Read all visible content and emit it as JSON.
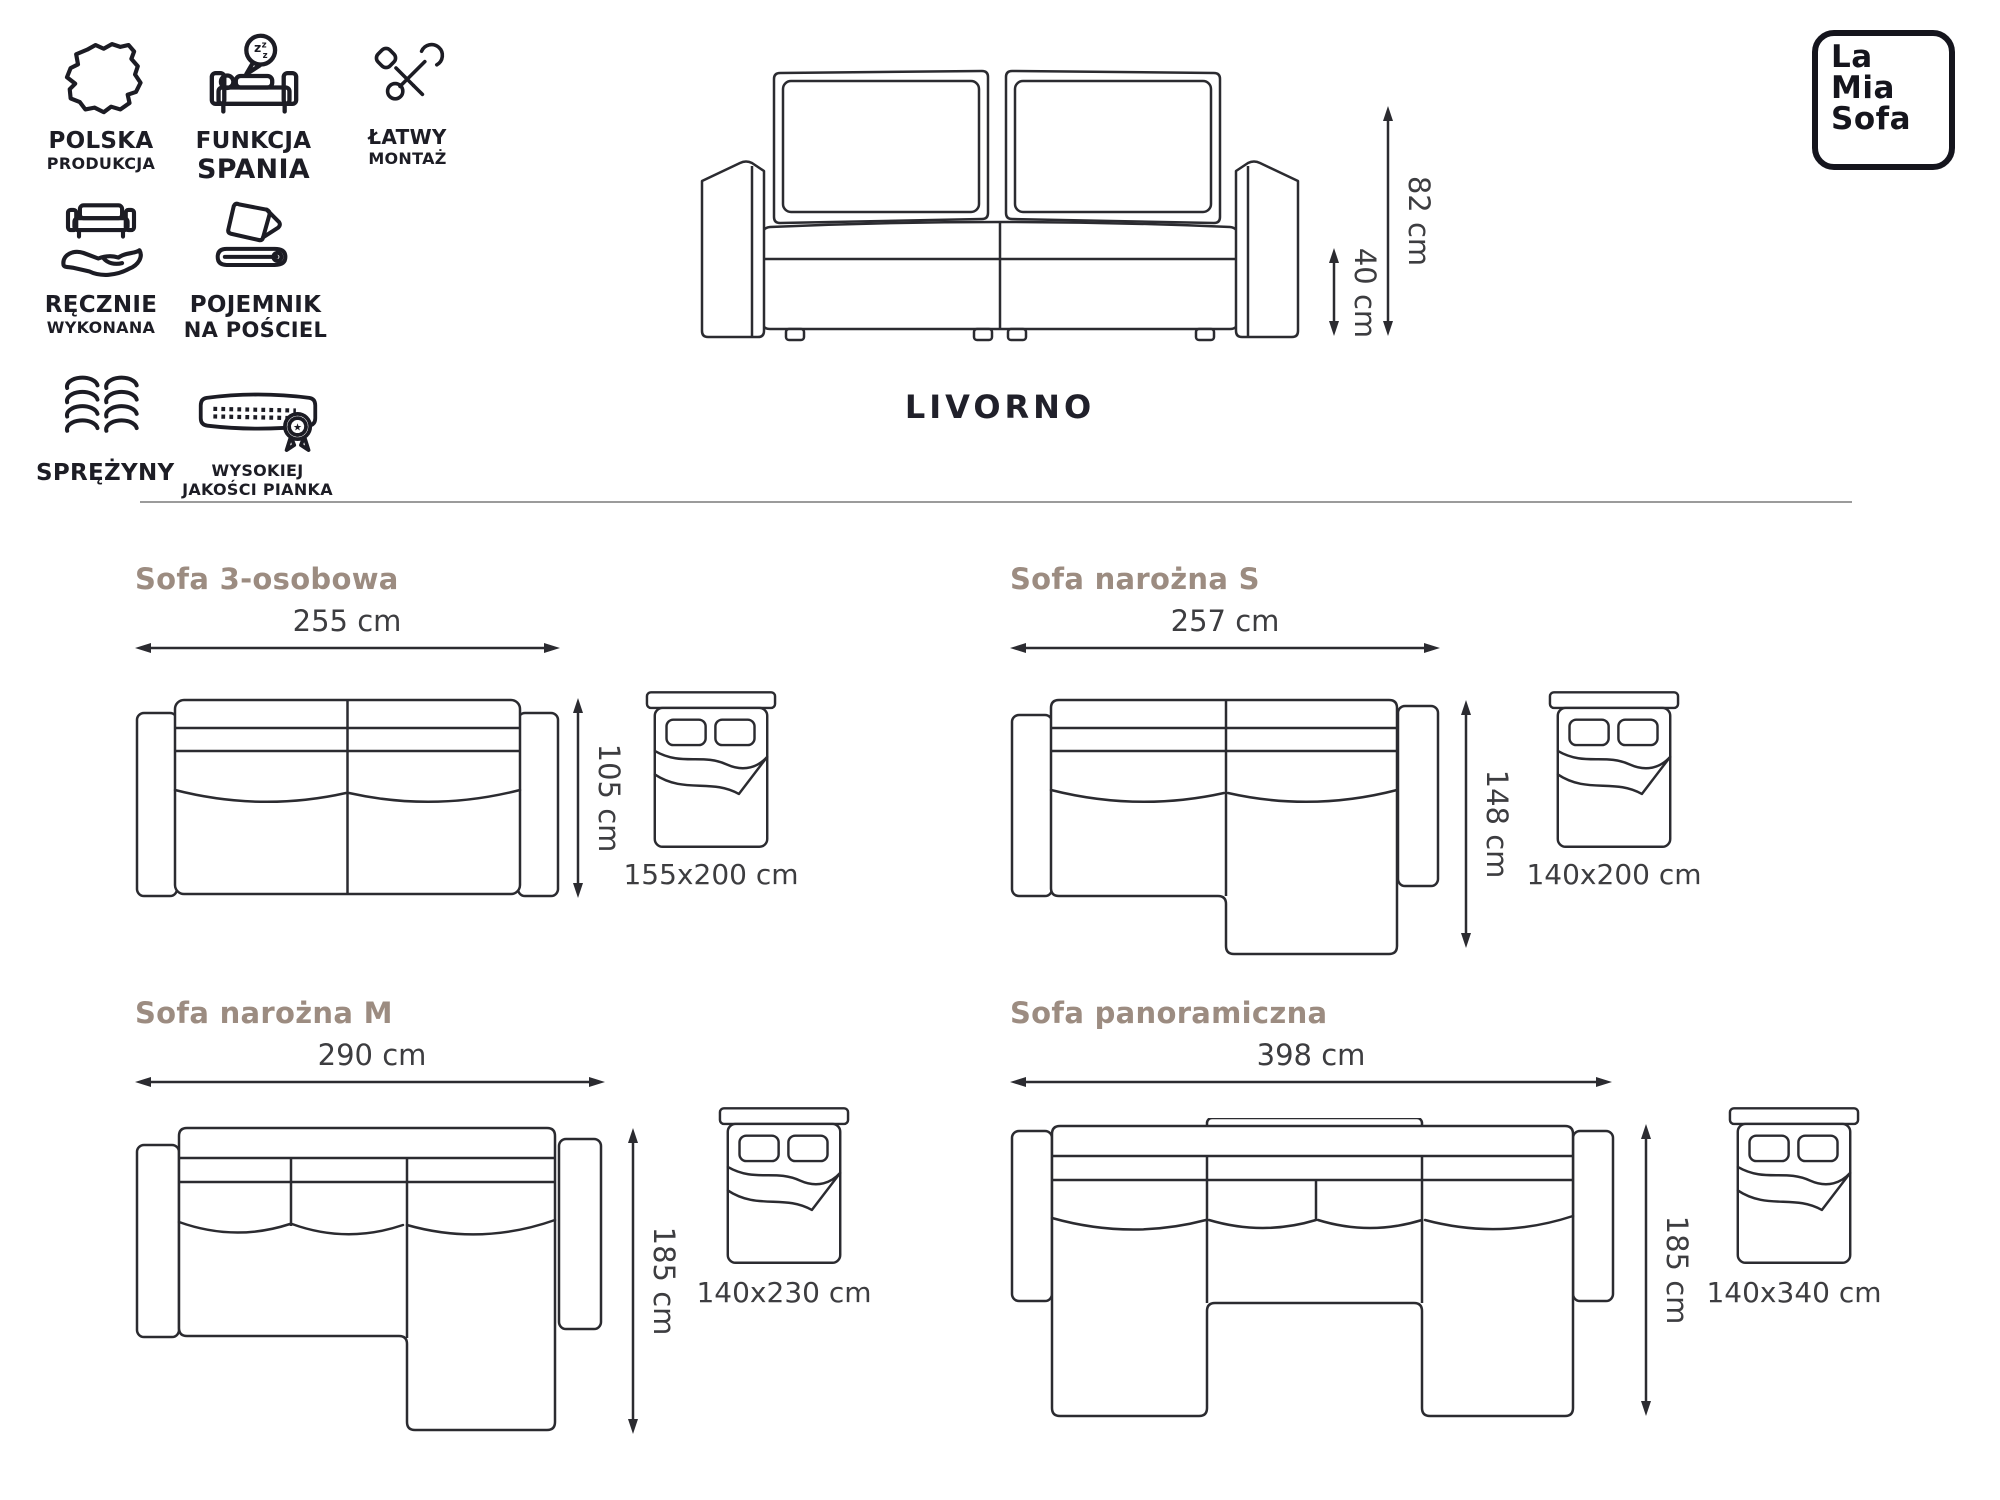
{
  "brand": {
    "name_lines": [
      "La",
      "Mia",
      "Sofa"
    ]
  },
  "product": {
    "name": "LIVORNO",
    "overall_height": "82 cm",
    "seat_height": "40 cm"
  },
  "features": [
    {
      "icon": "poland-map-icon",
      "line1": "POLSKA",
      "line2": "PRODUKCJA"
    },
    {
      "icon": "sleep-function-icon",
      "line1": "FUNKCJA",
      "line2": "SPANIA"
    },
    {
      "icon": "easy-assembly-icon",
      "line1": "ŁATWY",
      "line2": "MONTAŻ"
    },
    {
      "icon": "handmade-icon",
      "line1": "RĘCZNIE",
      "line2": "WYKONANA"
    },
    {
      "icon": "bedding-storage-icon",
      "line1": "POJEMNIK",
      "line2": "NA POŚCIEL"
    },
    {
      "icon": "springs-icon",
      "line1": "SPRĘŻYNY",
      "line2": ""
    },
    {
      "icon": "quality-foam-icon",
      "line1": "WYSOKIEJ",
      "line2": "JAKOŚCI PIANKA"
    }
  ],
  "variants": [
    {
      "title": "Sofa 3-osobowa",
      "width_label": "255 cm",
      "depth_label": "105 cm",
      "bed_label": "155x200 cm"
    },
    {
      "title": "Sofa narożna S",
      "width_label": "257 cm",
      "depth_label": "148 cm",
      "bed_label": "140x200 cm"
    },
    {
      "title": "Sofa narożna M",
      "width_label": "290 cm",
      "depth_label": "185 cm",
      "bed_label": "140x230 cm"
    },
    {
      "title": "Sofa panoramiczna",
      "width_label": "398 cm",
      "depth_label": "185 cm",
      "bed_label": "140x340 cm"
    }
  ],
  "colors": {
    "line_art": "#2b2b30",
    "variant_title": "#9c8c81",
    "dimension_text": "#3d3d40",
    "dark_text": "#1d1d25",
    "divider": "#9b9b9b"
  }
}
